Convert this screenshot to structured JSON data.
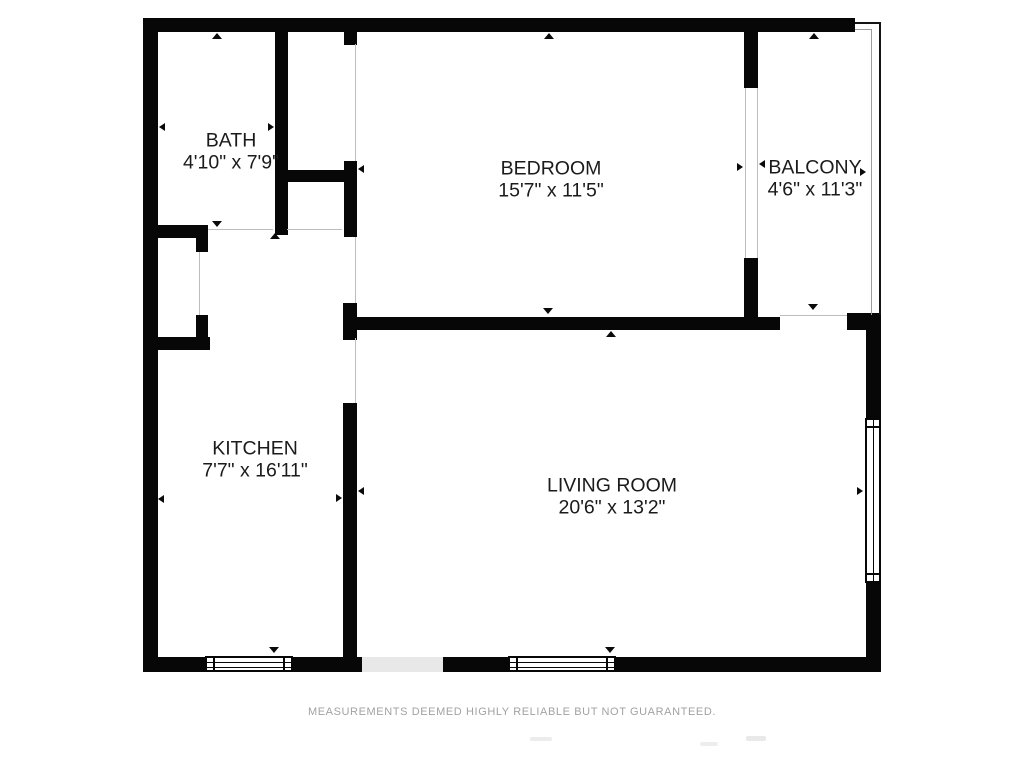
{
  "plan_title": "one-bedroom-floor-plan",
  "colors": {
    "wall": "#070707",
    "opening_line": "#bdbdbd",
    "entry_fill": "#e8e8e8",
    "label_text": "#1b1b1b",
    "disclaimer_text": "#a2a2a2"
  },
  "rooms": [
    {
      "name": "BATH",
      "dimensions": "4'10\" x 7'9\""
    },
    {
      "name": "BEDROOM",
      "dimensions": "15'7\" x 11'5\""
    },
    {
      "name": "BALCONY",
      "dimensions": "4'6\" x 11'3\""
    },
    {
      "name": "KITCHEN",
      "dimensions": "7'7\" x 16'11\""
    },
    {
      "name": "LIVING ROOM",
      "dimensions": "20'6\" x 13'2\""
    }
  ],
  "footer": {
    "disclaimer": "MEASUREMENTS DEEMED HIGHLY RELIABLE BUT NOT GUARANTEED."
  }
}
